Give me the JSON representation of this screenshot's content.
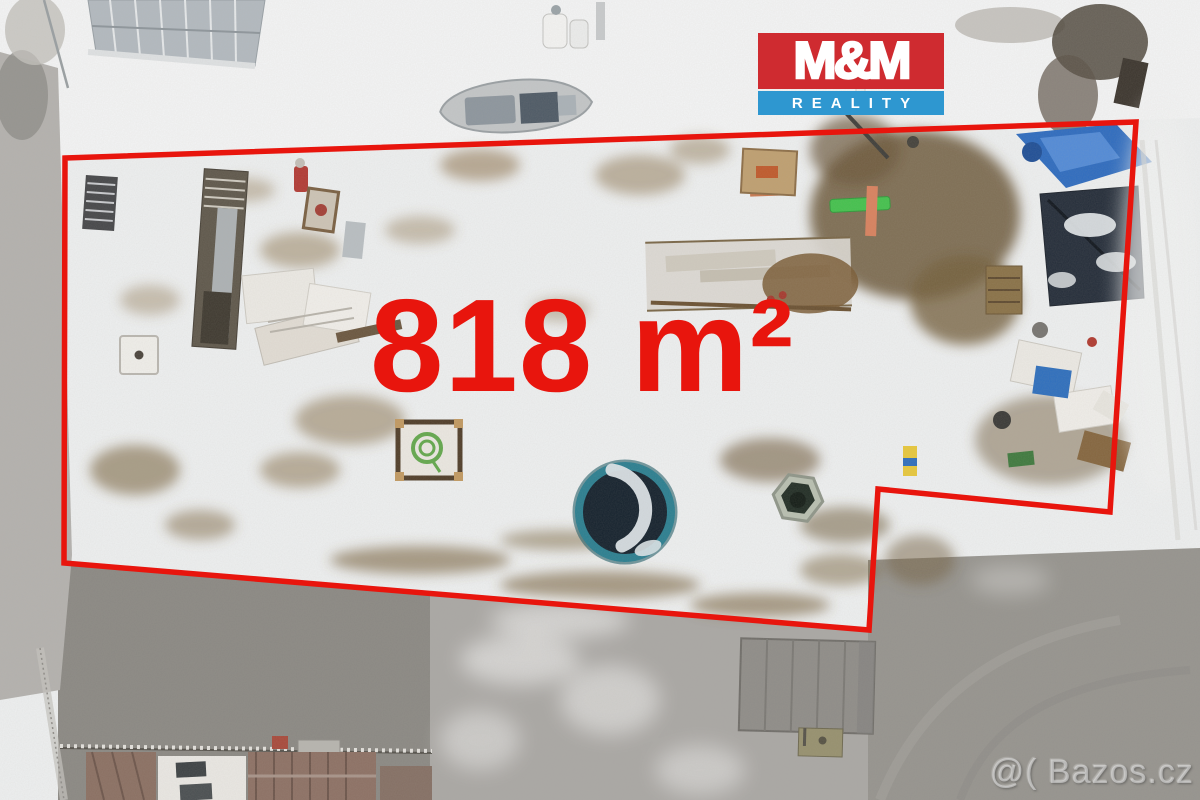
{
  "overlay": {
    "area_label": "818 m²",
    "area_label_color": "#e8150d",
    "boundary_points": "65,158 1136,122 1110,512 878,489 869,630 64,563",
    "boundary_color": "#e8150d",
    "boundary_width": "5.5"
  },
  "logo": {
    "title": "M&M",
    "subtitle": "REALITY",
    "title_bg": "#cf2b30",
    "subtitle_bg": "#2e97d0",
    "text_color": "#ffffff"
  },
  "watermark": {
    "text": "@( Bazos.cz"
  },
  "scene_colors": {
    "snow": "#eef0f1",
    "bright_snow": "#f4f5f6",
    "asphalt_dark": "#96948f",
    "asphalt_light": "#aaa8a5",
    "road_left": "#b4b2af",
    "trampoline_rim": "#2b7f91",
    "trampoline_mat": "#15222e",
    "tarp_blue": "#2e6cc0",
    "shed_dark": "#242d3a",
    "bench_green": "#44c24e",
    "dirt_brown": "#77613f"
  }
}
